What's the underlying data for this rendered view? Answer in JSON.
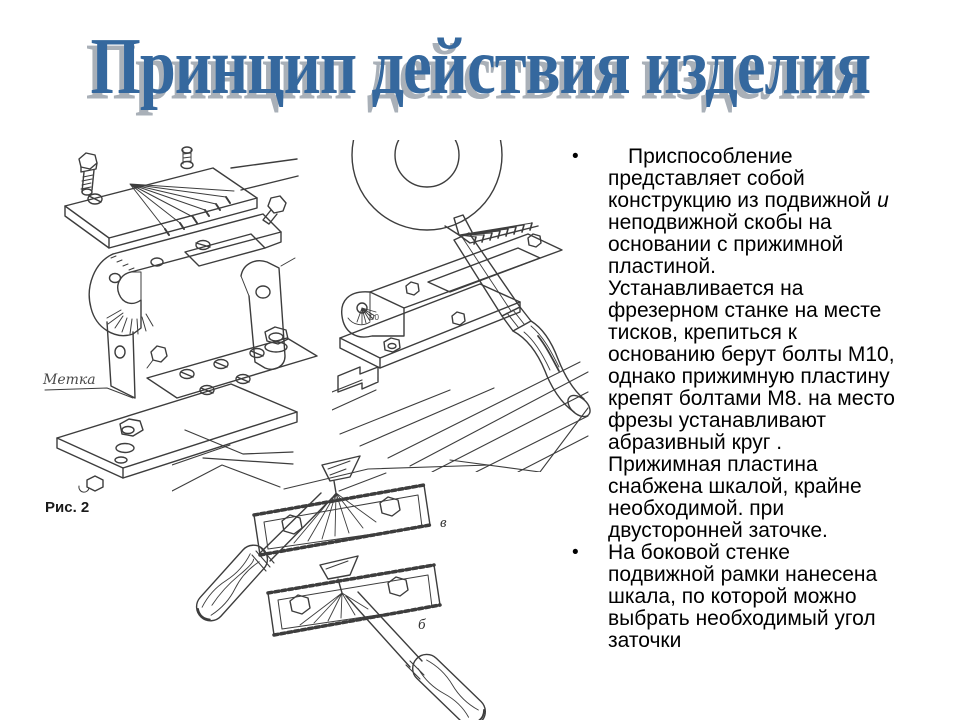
{
  "title": {
    "text": "Принцип действия изделия"
  },
  "figures": {
    "exploded_view": {
      "caption": "Рис. 2",
      "metka_label": "Метка"
    },
    "machine_view": {
      "dial_label": "90"
    },
    "plates_view": {
      "plate_a_label": "в",
      "plate_b_label": "б"
    }
  },
  "bullets": [
    {
      "marker": "•",
      "p1": "Приспособление представляет собой конструкцию из подвижной ",
      "italic_word": "и",
      "p2": " неподвижной скобы на основании с прижимной пластиной.",
      "p3": "Устанавливается на фрезерном станке на месте тисков, крепиться к основанию берут болты М10, однако прижимную пластину крепят болтами М8. на место фрезы устанавливают абразивный круг . Прижимная пластина снабжена шкалой, крайне необходимой. при двусторонней заточке."
    },
    {
      "marker": "•",
      "p1": "На боковой стенке подвижной рамки нанесена шкала, по которой можно выбрать необходимый угол заточки"
    }
  ],
  "colors": {
    "title": "#35689e",
    "title_shadow": "#a9b0b8",
    "ink": "#3d3d3d",
    "text": "#000000",
    "background": "#ffffff"
  }
}
